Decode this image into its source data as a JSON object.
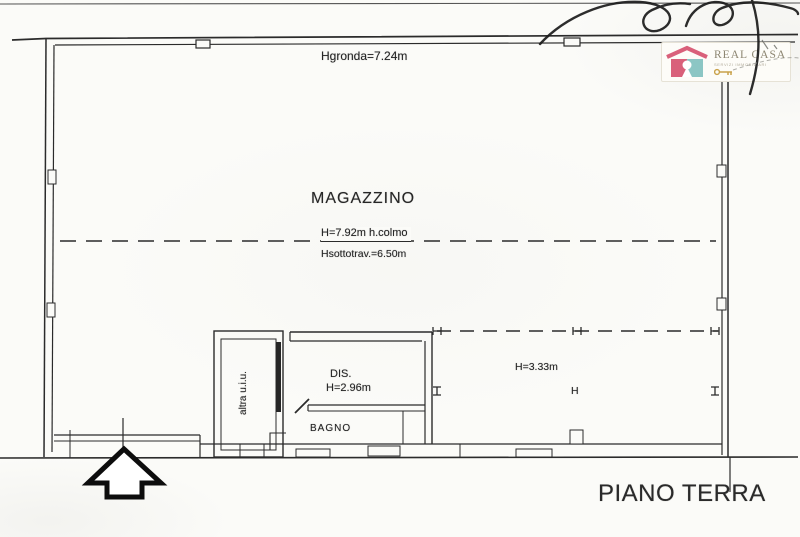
{
  "labels": {
    "hgronda": "Hgronda=7.24m",
    "magazzino": "MAGAZZINO",
    "colmo": "H=7.92m h.colmo",
    "sottotrave": "Hsottotrav.=6.50m",
    "dis": "DIS.",
    "dis_height": "H=2.96m",
    "bagno": "BAGNO",
    "altra_unit": "altra u.i.u.",
    "area_height": "H=3.33m",
    "column_mark": "H",
    "title": "PIANO TERRA"
  },
  "logo": {
    "brand": "REAL CASA",
    "tagline": "SERVIZI IMMOBILIARI",
    "colors": {
      "pink": "#d9607a",
      "teal": "#8cc6c4",
      "text": "#8d8672",
      "key": "#c9a24a"
    }
  },
  "colors": {
    "paper": "#fbfbf8",
    "ink": "#2b2b2b",
    "arrow": "#0d0d0d"
  }
}
